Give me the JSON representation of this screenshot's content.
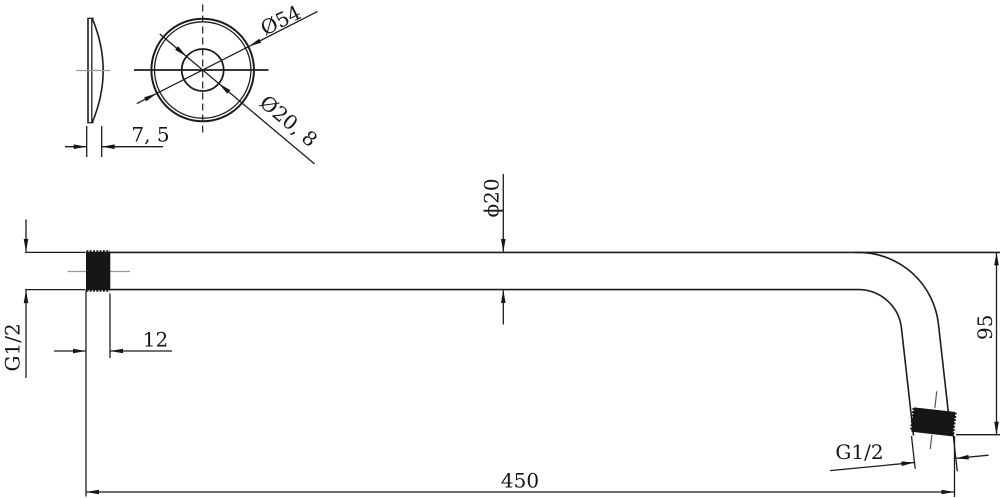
{
  "drawing": {
    "flange": {
      "thickness": "7, 5",
      "outer_diameter": "Ø54",
      "hole_diameter": "Ø20, 8"
    },
    "arm": {
      "inlet_thread": "G1/2",
      "inlet_thread_length": "12",
      "length": "450",
      "tube_diameter": "ϕ20",
      "drop": "95",
      "outlet_thread": "G1/2"
    },
    "colors": {
      "line": "#1c1c1c",
      "centerline": "#9a9a9a",
      "fill_thread": "#161616",
      "background": "#ffffff"
    }
  }
}
